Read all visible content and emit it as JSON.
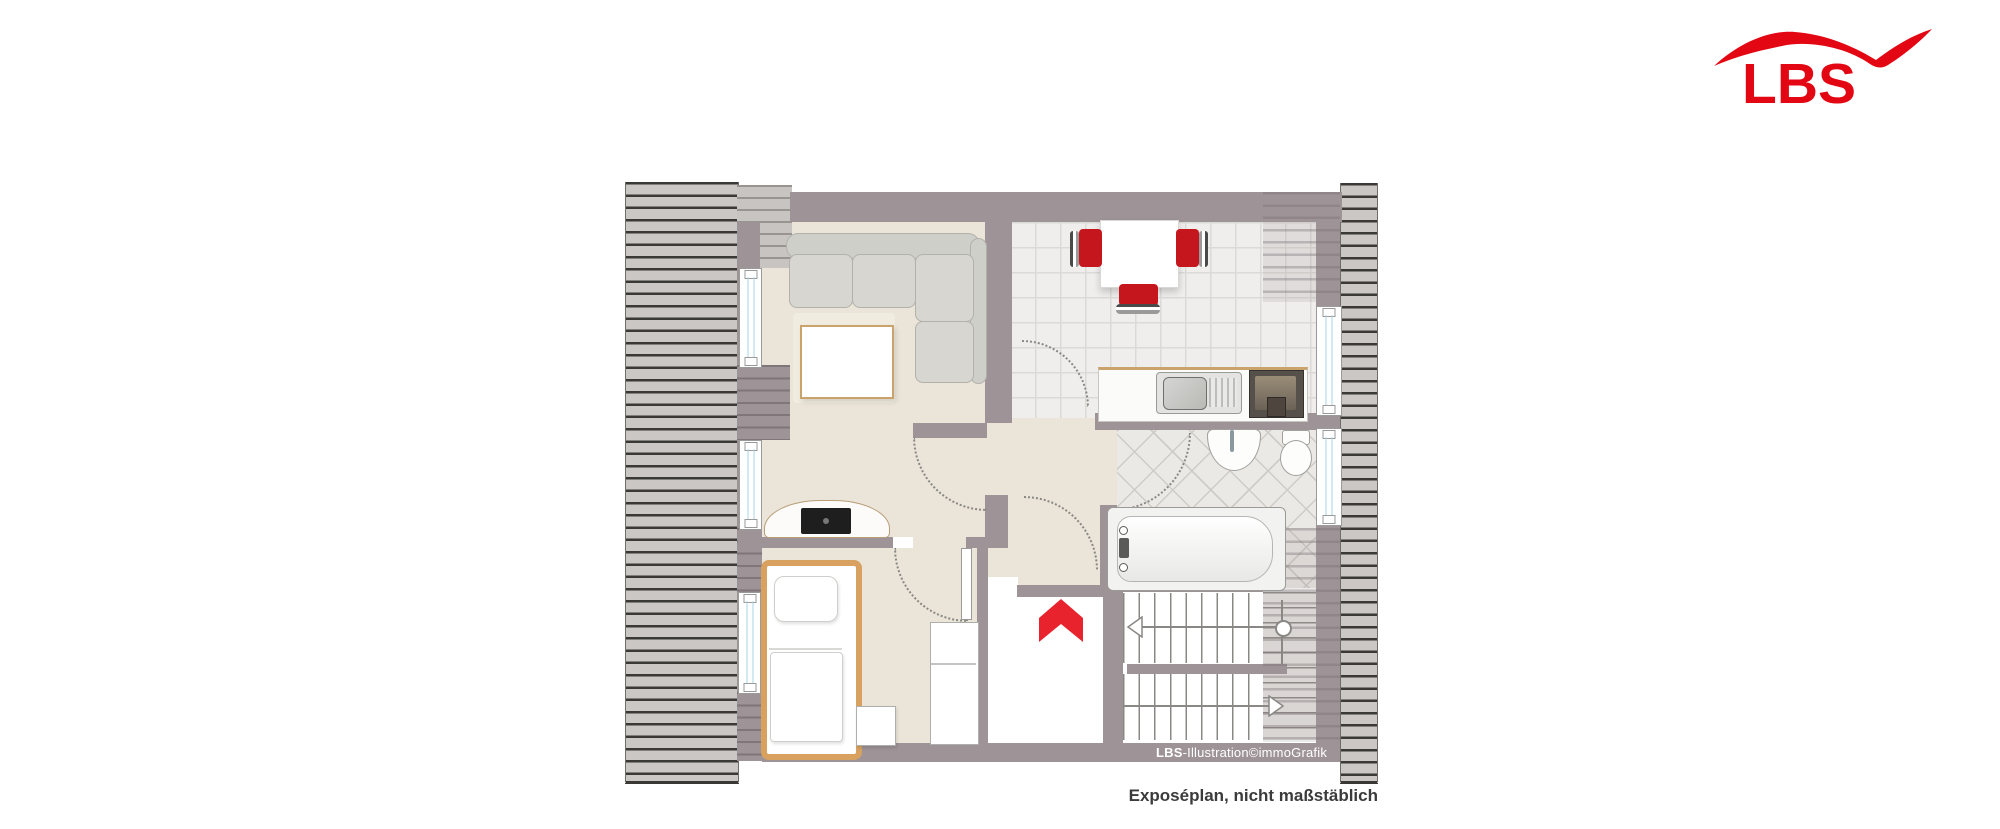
{
  "logo": {
    "text": "LBS"
  },
  "captions": {
    "credit_bold": "LBS",
    "credit_rest": "-Illustration©immoGrafik",
    "note": "Exposéplan, nicht maßstäblich"
  },
  "colors": {
    "wall": "#9e9397",
    "hatch_fill": "#cac7c4",
    "hatch_line": "#3a3936",
    "hatch_light_fill": "#c7c4c1",
    "hatch_light_line": "#98948f",
    "floor_beige": "#eae5d8",
    "tile_kitchen": "#efeeec",
    "tile_bath": "#eae9e5",
    "window_glass": "#aad4e4",
    "furniture_gray": "#d7d6d1",
    "wood": "#d8a160",
    "table_edge": "#c9a36b",
    "red_logo": "#e30613",
    "red_arrow": "#e8232e",
    "red_chair": "#c5161d",
    "stair_line": "#8a8884",
    "note_text": "#3b3b3b"
  }
}
